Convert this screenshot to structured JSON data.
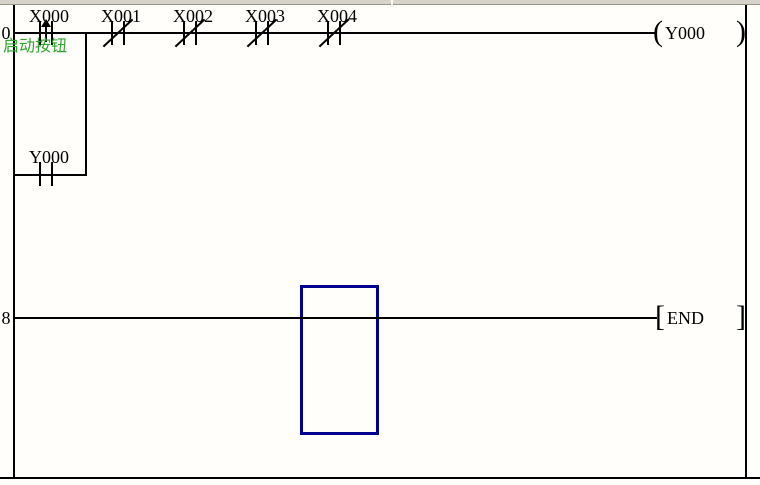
{
  "editor": {
    "rung0": {
      "number": "0",
      "contacts": [
        {
          "label": "X000",
          "type": "rising-edge",
          "comment": "启动按钮"
        },
        {
          "label": "X001",
          "type": "normally-closed"
        },
        {
          "label": "X002",
          "type": "normally-closed"
        },
        {
          "label": "X003",
          "type": "normally-closed"
        },
        {
          "label": "X004",
          "type": "normally-closed"
        }
      ],
      "branch": {
        "label": "Y000",
        "type": "normally-open"
      },
      "coil": {
        "open": "(",
        "label": "Y000",
        "close": ")"
      }
    },
    "rung8": {
      "number": "8",
      "instruction": {
        "open": "[",
        "label": "END",
        "close": "]"
      }
    },
    "colors": {
      "wire": "#000000",
      "comment_text": "#2ea52e",
      "cursor_border": "#000090",
      "toolbar_edge": "#d7d3cb"
    }
  }
}
